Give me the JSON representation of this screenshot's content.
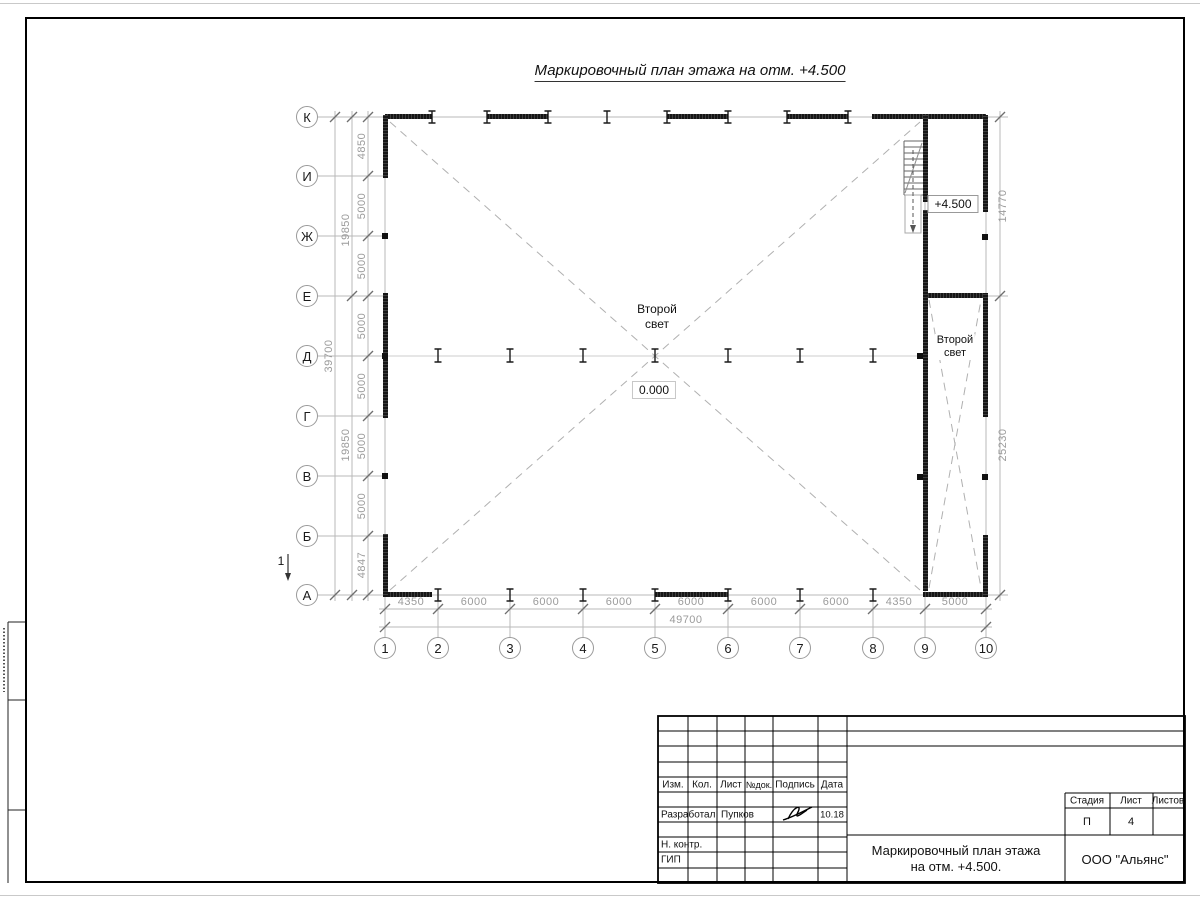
{
  "sheet": {
    "title": "Маркировочный план этажа на отм. +4.500"
  },
  "plan": {
    "row_axes": [
      "К",
      "И",
      "Ж",
      "Е",
      "Д",
      "Г",
      "В",
      "Б",
      "А"
    ],
    "col_axes": [
      "1",
      "2",
      "3",
      "4",
      "5",
      "6",
      "7",
      "8",
      "9",
      "10"
    ],
    "labels": {
      "second_light_line1": "Второй",
      "second_light_line2": "свет",
      "level_zero": "0.000",
      "level_upper": "+4.500",
      "section_mark": "1"
    },
    "dimensions": {
      "left_bays": [
        "4850",
        "5000",
        "5000",
        "5000",
        "5000",
        "5000",
        "5000",
        "4847"
      ],
      "left_halves": [
        "19850",
        "19850"
      ],
      "left_total": "39700",
      "bottom_bays": [
        "4350",
        "6000",
        "6000",
        "6000",
        "6000",
        "6000",
        "6000",
        "4350",
        "5000"
      ],
      "bottom_total": "49700",
      "right_upper": "14770",
      "right_lower": "25230"
    }
  },
  "titleblock": {
    "columns": [
      "Изм.",
      "Кол.",
      "Лист",
      "№док.",
      "Подпись",
      "Дата"
    ],
    "developer_label": "Разработал",
    "developer_name": "Пупков",
    "developer_date": "10.18",
    "n_contr_label": "Н. контр.",
    "gip_label": "ГИП",
    "stage_headers": [
      "Стадия",
      "Лист",
      "Листов"
    ],
    "stage_value": "П",
    "sheet_value": "4",
    "doc_title_line1": "Маркировочный план этажа",
    "doc_title_line2": "на отм. +4.500.",
    "company": "ООО \"Альянс\""
  },
  "colors": {
    "wall": "#1c1c1c",
    "grid_line": "#b8b8b8",
    "dim_text": "#9b9b9b",
    "frame_line": "#000000"
  }
}
